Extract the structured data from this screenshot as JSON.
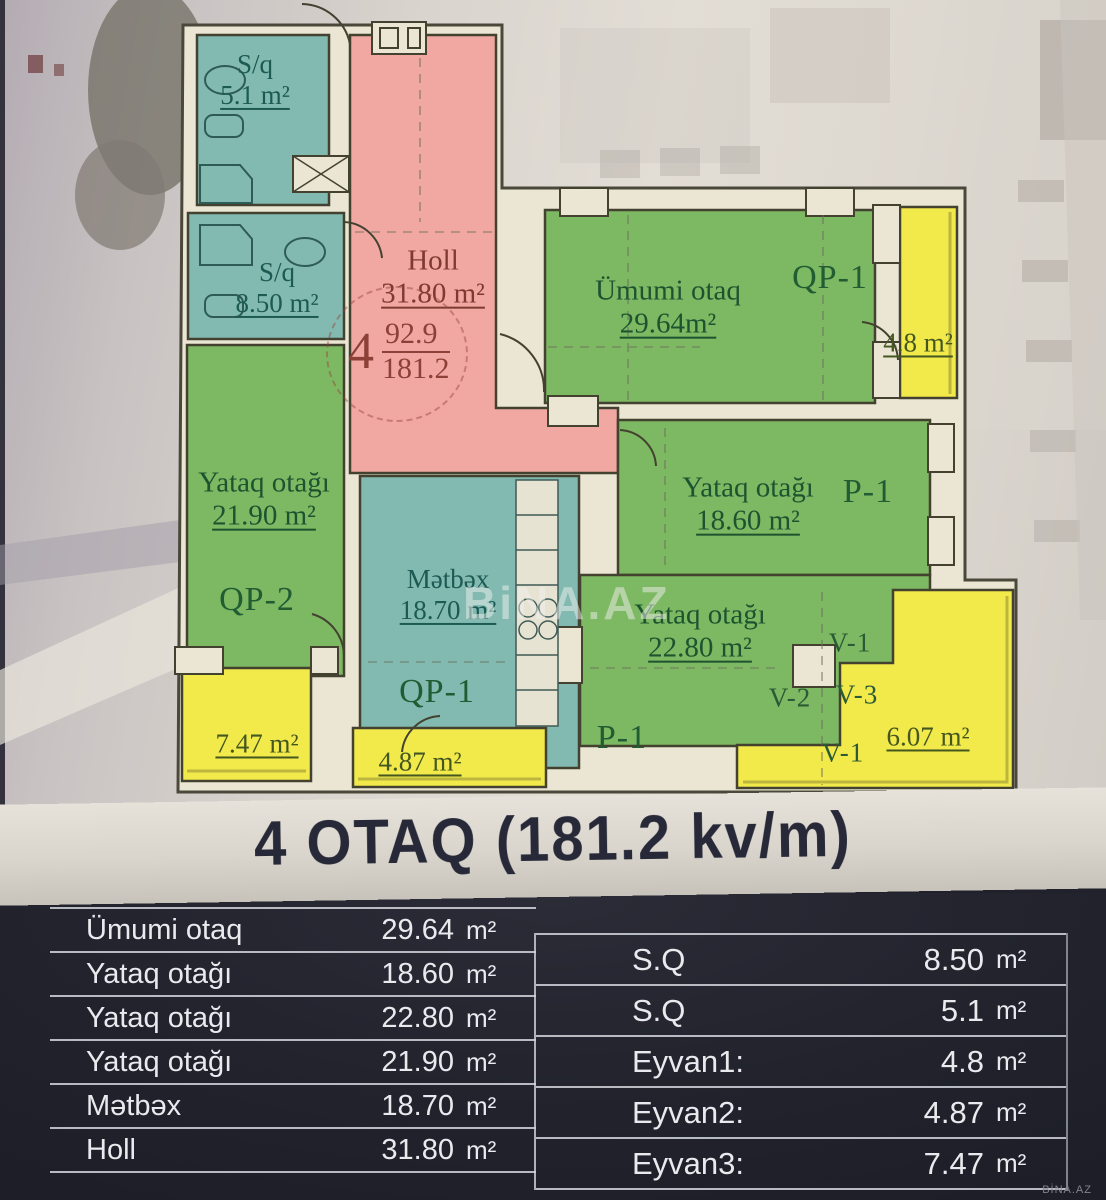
{
  "plan": {
    "watermark": "BiNA.AZ",
    "badge": {
      "rooms_count": "4",
      "numerator": "92.9",
      "denominator": "181.2"
    },
    "rooms": {
      "bath_small": {
        "name": "S/q",
        "area": "5.1 m²"
      },
      "bath_large": {
        "name": "S/q",
        "area": "8.50 m²"
      },
      "hall": {
        "name": "Holl",
        "area": "31.80 m²"
      },
      "living": {
        "name": "Ümumi otaq",
        "area": "29.64m²"
      },
      "bedroom_left": {
        "name": "Yataq otağı",
        "area": "21.90 m²"
      },
      "bedroom_mid": {
        "name": "Yataq otağı",
        "area": "18.60 m²"
      },
      "bedroom_bottom": {
        "name": "Yataq otağı",
        "area": "22.80 m²"
      },
      "kitchen": {
        "name": "Mətbəx",
        "area": "18.70 m²"
      }
    },
    "balconies": {
      "top_right": "4.8 m²",
      "bottom_left": "7.47 m²",
      "bottom_mid": "4.87 m²",
      "bottom_right": "6.07 m²"
    },
    "markers": {
      "qp1_top": "QP-1",
      "qp2": "QP-2",
      "qp1_kitchen": "QP-1",
      "p1_mid": "P-1",
      "p1_bottom": "P-1",
      "v1_upper": "V-1",
      "v2": "V-2",
      "v3": "V-3",
      "v1_lower": "V-1"
    },
    "colors": {
      "room_green": "#7db863",
      "room_teal": "#82bab1",
      "hall_pink": "#f1a8a2",
      "balcony_yellow": "#f2e94b",
      "wall_cream": "#ebe6d4",
      "panel_navy": "#22232d"
    }
  },
  "title": "4 OTAQ (181.2 kv/m)",
  "summary_left": {
    "rows": [
      {
        "label": "Ümumi otaq",
        "value": "29.64",
        "unit": "m²"
      },
      {
        "label": "Yataq otağı",
        "value": "18.60",
        "unit": "m²"
      },
      {
        "label": "Yataq otağı",
        "value": "22.80",
        "unit": "m²"
      },
      {
        "label": "Yataq otağı",
        "value": "21.90",
        "unit": "m²"
      },
      {
        "label": "Mətbəx",
        "value": "18.70",
        "unit": "m²"
      },
      {
        "label": "Holl",
        "value": "31.80",
        "unit": "m²"
      }
    ]
  },
  "summary_right": {
    "rows": [
      {
        "label": "S.Q",
        "value": "8.50",
        "unit": "m²"
      },
      {
        "label": "S.Q",
        "value": "5.1",
        "unit": "m²"
      },
      {
        "label": "Eyvan1:",
        "value": "4.8",
        "unit": "m²"
      },
      {
        "label": "Eyvan2:",
        "value": "4.87",
        "unit": "m²"
      },
      {
        "label": "Eyvan3:",
        "value": "7.47",
        "unit": "m²"
      }
    ]
  },
  "footer_watermark": "BİNA.AZ"
}
